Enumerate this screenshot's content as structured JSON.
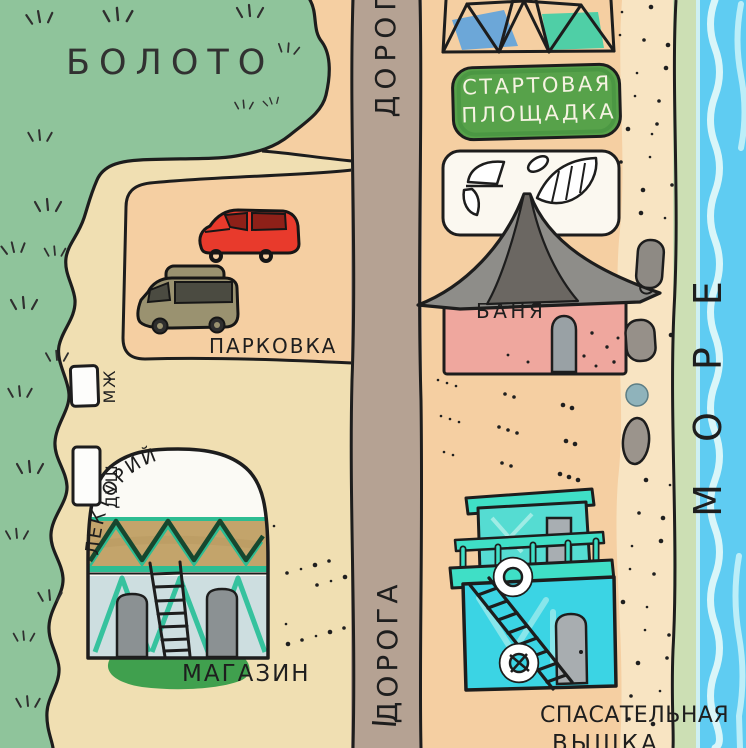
{
  "labels": {
    "swamp": "БОЛОТО",
    "road_top": "ДОРОГА",
    "road_bottom": "ДОРОГА",
    "parking": "ПАРКОВКА",
    "toilet": "МЖ",
    "shower": "ДУШ",
    "lecture_hall": "ЛЕКТОРИЙ",
    "shop": "МАГАЗИН",
    "launch_line1": "СТАРТОВАЯ",
    "launch_line2": "ПЛОЩАДКА",
    "bathhouse": "БАНЯ",
    "lifeguard_line1": "СПАСАТЕЛЬНАЯ",
    "lifeguard_line2": "ВЫШКА",
    "sea": "МОРЕ"
  },
  "colors": {
    "swamp_green": "#8fc49b",
    "sand_light": "#f0dfb2",
    "sand_peach": "#f5cfa2",
    "beach_sand": "#f8e4c2",
    "road_brown": "#b5a293",
    "sea_blue": "#5fccf2",
    "shore_green": "#ccdfb4",
    "foam": "#d9f6f9",
    "sign_green": "#57a24a",
    "bathhouse_pink": "#efa79e",
    "roof_gray": "#8e8d89",
    "tower_cyan": "#3bd4e4",
    "tower_teal": "#3fdfc6",
    "outline": "#1d1d1d"
  },
  "icons": [
    "dome-tent-icon",
    "red-car-icon",
    "camper-van-icon",
    "sail-wings-icon",
    "pyramid-roof-icon",
    "lifeguard-tower-icon",
    "lifebuoy-icon",
    "ladder-icon",
    "stone-icon",
    "grass-tuft-icon",
    "wave-icon",
    "toilet-cabin-icon",
    "shower-cabin-icon"
  ]
}
